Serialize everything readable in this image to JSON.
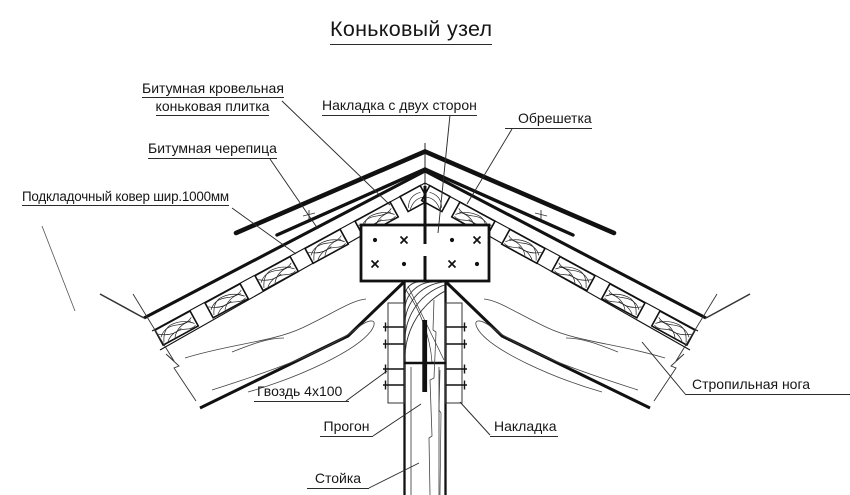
{
  "title": "Коньковый узел",
  "labels": {
    "ridge_tile_1": "Битумная кровельная",
    "ridge_tile_2": "коньковая плитка",
    "shingles": "Битумная черепица",
    "underlayment": "Подкладочный ковер шир.1000мм",
    "overlay_both_sides": "Накладка с двух сторон",
    "sheathing": "Обрешетка",
    "rafter": "Стропильная нога",
    "nail": "Гвоздь 4x100",
    "purlin": "Прогон",
    "overlay": "Накладка",
    "post": "Стойка"
  },
  "colors": {
    "line": "#141414",
    "text": "#161616",
    "background": "#ffffff"
  }
}
